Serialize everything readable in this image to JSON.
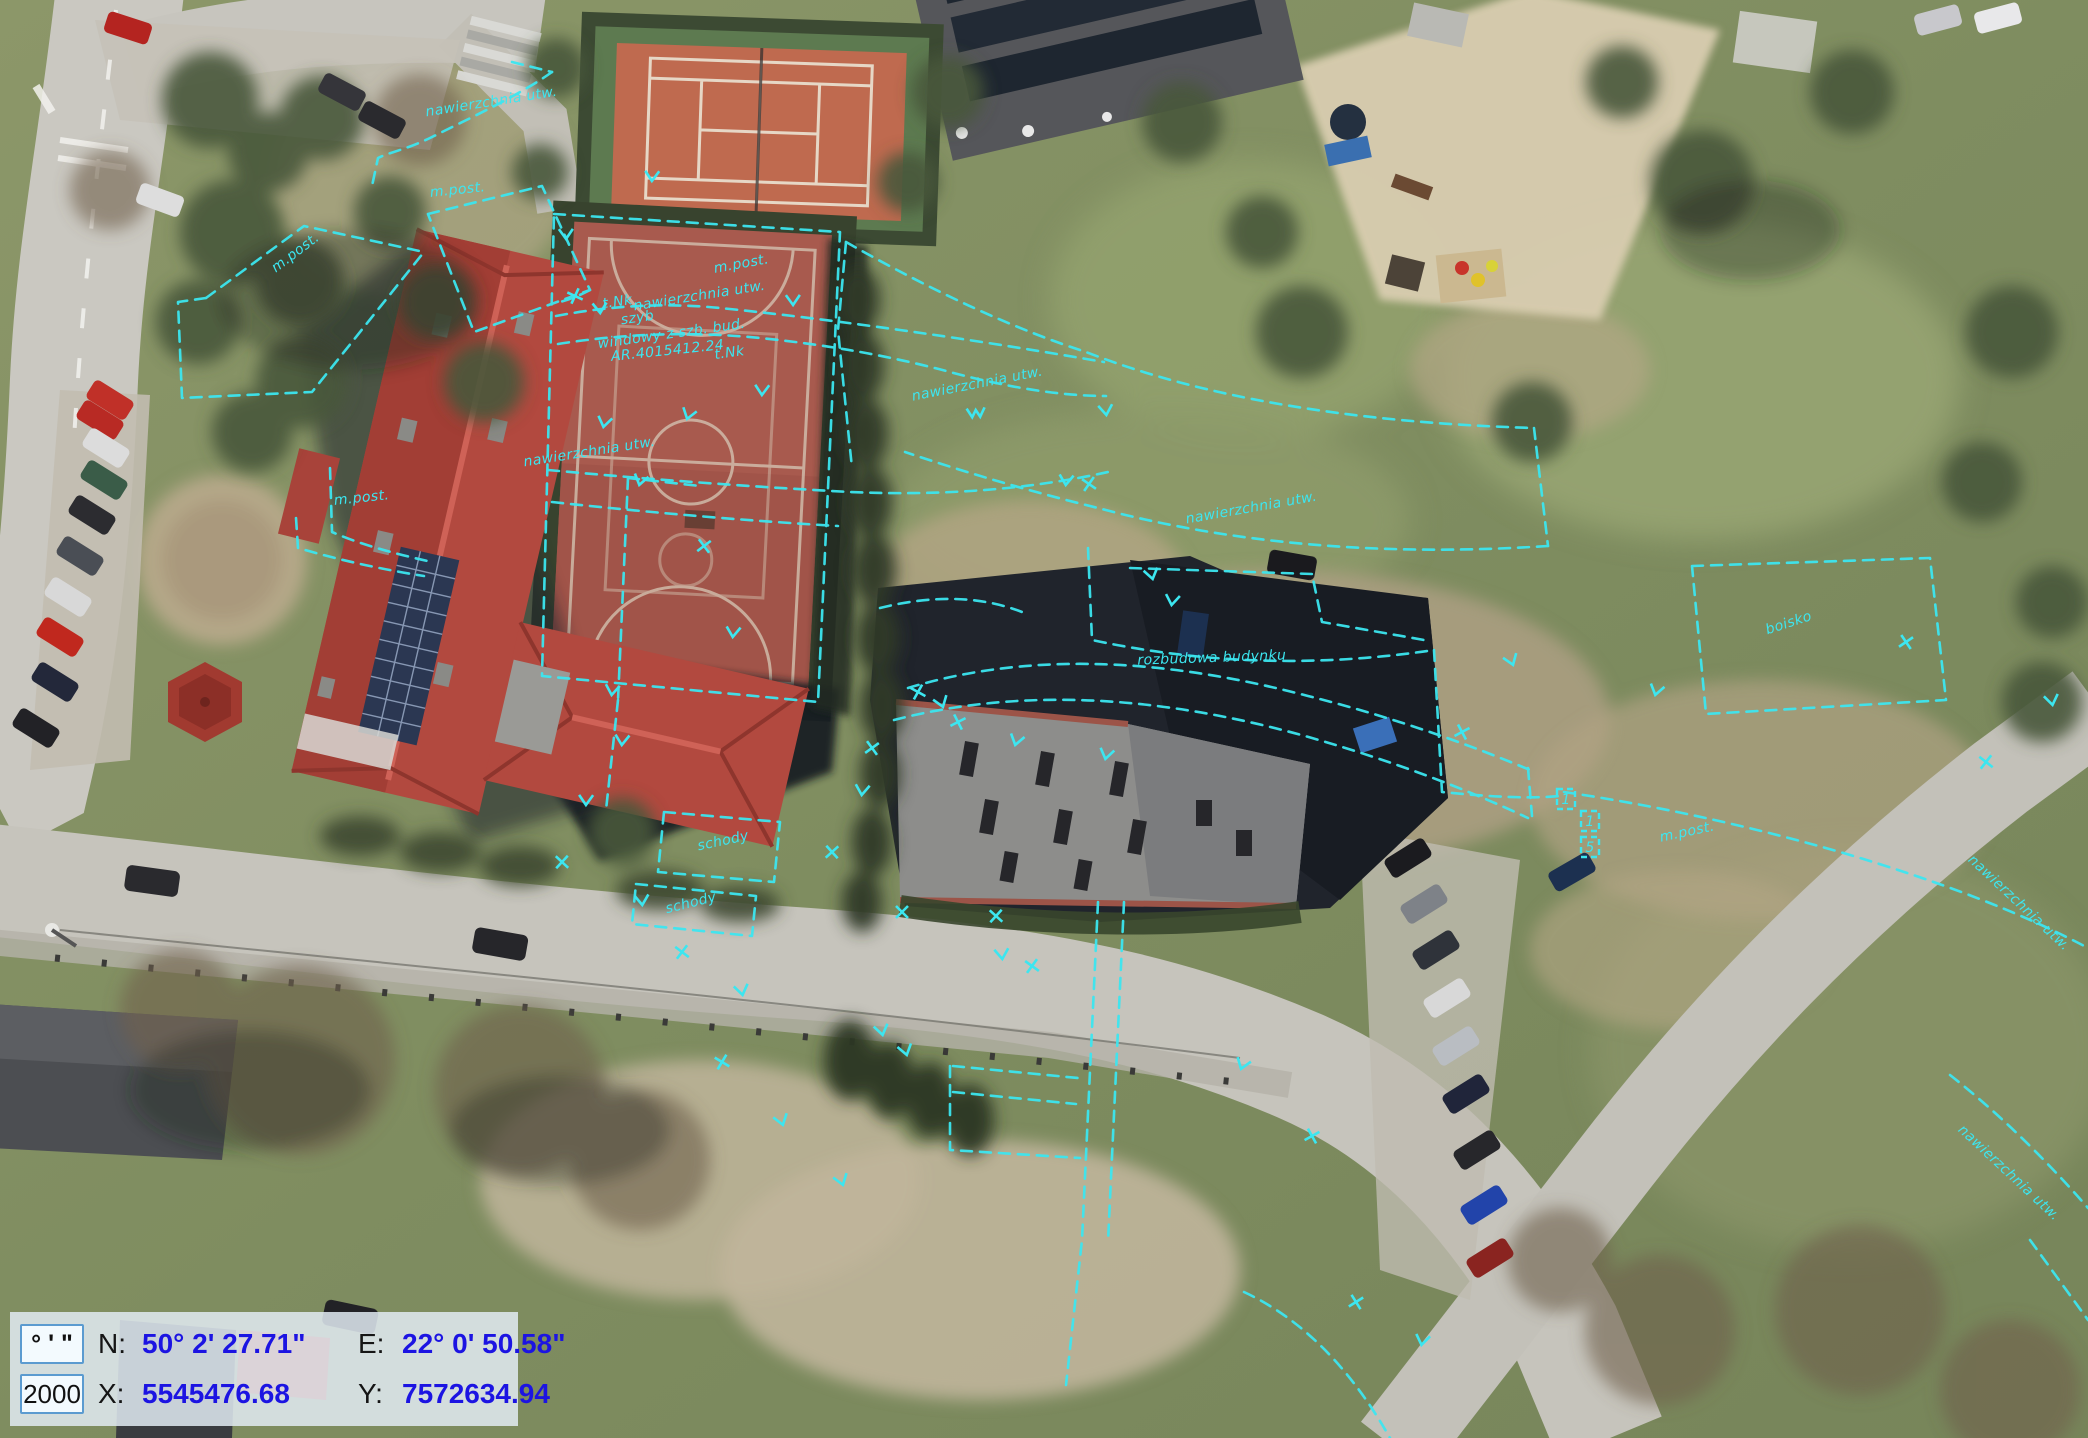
{
  "app": {
    "view": "aerial-survey-map"
  },
  "coordinate_panel": {
    "unit_format_button": "° ' \"",
    "crs_code_button": "2000",
    "lat_label": "N:",
    "lat_value": "50° 2' 27.71\"",
    "lon_label": "E:",
    "lon_value": "22° 0' 50.58\"",
    "x_label": "X:",
    "x_value": "5545476.68",
    "y_label": "Y:",
    "y_value": "7572634.94",
    "value_color": "#1c14e2"
  },
  "overlay": {
    "color": "#3ce6f0",
    "labels": [
      {
        "text": "nawierzchnia utw.",
        "x": 492,
        "y": 106,
        "rot": -9
      },
      {
        "text": "m.post.",
        "x": 298,
        "y": 256,
        "rot": -37
      },
      {
        "text": "m.post.",
        "x": 458,
        "y": 194,
        "rot": -6
      },
      {
        "text": "t.Nk",
        "x": 618,
        "y": 306,
        "rot": -8
      },
      {
        "text": "szyb",
        "x": 638,
        "y": 322,
        "rot": -8
      },
      {
        "text": "windowy z szb. bud.",
        "x": 672,
        "y": 338,
        "rot": -8
      },
      {
        "text": "AR.4015412.24",
        "x": 668,
        "y": 355,
        "rot": -6
      },
      {
        "text": "t.Nk",
        "x": 730,
        "y": 357,
        "rot": -8
      },
      {
        "text": "m.post.",
        "x": 742,
        "y": 268,
        "rot": -10
      },
      {
        "text": "nawierzchnia utw.",
        "x": 700,
        "y": 300,
        "rot": -9
      },
      {
        "text": "nawierzchnia utw.",
        "x": 590,
        "y": 456,
        "rot": -9
      },
      {
        "text": "nawierzchnia utw.",
        "x": 978,
        "y": 388,
        "rot": -11
      },
      {
        "text": "nawierzchnia utw.",
        "x": 1252,
        "y": 512,
        "rot": -10
      },
      {
        "text": "rozbudowa budynku",
        "x": 1212,
        "y": 662,
        "rot": -2
      },
      {
        "text": "boisko",
        "x": 1790,
        "y": 627,
        "rot": -18
      },
      {
        "text": "m.post.",
        "x": 1688,
        "y": 836,
        "rot": -12
      },
      {
        "text": "m.post.",
        "x": 362,
        "y": 502,
        "rot": -6
      },
      {
        "text": "schody",
        "x": 724,
        "y": 845,
        "rot": -12
      },
      {
        "text": "schody",
        "x": 692,
        "y": 907,
        "rot": -14
      },
      {
        "text": "nawierzchnia utw.",
        "x": 2016,
        "y": 906,
        "rot": 43
      },
      {
        "text": "nawierzchnia utw.",
        "x": 2006,
        "y": 1176,
        "rot": 43
      }
    ],
    "number_boxes": [
      {
        "value": "1",
        "x": 1566,
        "y": 800
      },
      {
        "value": "1",
        "x": 1590,
        "y": 822
      },
      {
        "value": "5",
        "x": 1590,
        "y": 848
      }
    ],
    "ticks": [
      {
        "x": 575,
        "y": 296,
        "t": "x"
      },
      {
        "x": 688,
        "y": 416,
        "t": "v"
      },
      {
        "x": 640,
        "y": 482,
        "t": "v"
      },
      {
        "x": 604,
        "y": 424,
        "t": "v"
      },
      {
        "x": 704,
        "y": 546,
        "t": "x"
      },
      {
        "x": 733,
        "y": 634,
        "t": "v"
      },
      {
        "x": 762,
        "y": 392,
        "t": "v"
      },
      {
        "x": 793,
        "y": 302,
        "t": "v"
      },
      {
        "x": 976,
        "y": 414,
        "t": "w"
      },
      {
        "x": 1106,
        "y": 412,
        "t": "v"
      },
      {
        "x": 1089,
        "y": 484,
        "t": "x"
      },
      {
        "x": 1152,
        "y": 576,
        "t": "v"
      },
      {
        "x": 918,
        "y": 692,
        "t": "x"
      },
      {
        "x": 942,
        "y": 704,
        "t": "v"
      },
      {
        "x": 958,
        "y": 722,
        "t": "x"
      },
      {
        "x": 1016,
        "y": 742,
        "t": "v"
      },
      {
        "x": 1106,
        "y": 756,
        "t": "v"
      },
      {
        "x": 872,
        "y": 748,
        "t": "x"
      },
      {
        "x": 862,
        "y": 792,
        "t": "v"
      },
      {
        "x": 832,
        "y": 852,
        "t": "x"
      },
      {
        "x": 902,
        "y": 912,
        "t": "x"
      },
      {
        "x": 996,
        "y": 916,
        "t": "x"
      },
      {
        "x": 1002,
        "y": 956,
        "t": "v"
      },
      {
        "x": 1032,
        "y": 966,
        "t": "x"
      },
      {
        "x": 882,
        "y": 1032,
        "t": "v"
      },
      {
        "x": 906,
        "y": 1052,
        "t": "v"
      },
      {
        "x": 842,
        "y": 1182,
        "t": "v"
      },
      {
        "x": 1242,
        "y": 1066,
        "t": "v"
      },
      {
        "x": 1312,
        "y": 1136,
        "t": "x"
      },
      {
        "x": 1356,
        "y": 1302,
        "t": "x"
      },
      {
        "x": 1422,
        "y": 1342,
        "t": "v"
      },
      {
        "x": 612,
        "y": 692,
        "t": "v"
      },
      {
        "x": 622,
        "y": 742,
        "t": "v"
      },
      {
        "x": 586,
        "y": 802,
        "t": "v"
      },
      {
        "x": 562,
        "y": 862,
        "t": "x"
      },
      {
        "x": 642,
        "y": 902,
        "t": "v"
      },
      {
        "x": 682,
        "y": 952,
        "t": "x"
      },
      {
        "x": 742,
        "y": 992,
        "t": "v"
      },
      {
        "x": 722,
        "y": 1062,
        "t": "x"
      },
      {
        "x": 782,
        "y": 1122,
        "t": "v"
      },
      {
        "x": 1512,
        "y": 662,
        "t": "v"
      },
      {
        "x": 1462,
        "y": 732,
        "t": "x"
      },
      {
        "x": 1656,
        "y": 692,
        "t": "v"
      },
      {
        "x": 1906,
        "y": 642,
        "t": "x"
      },
      {
        "x": 1172,
        "y": 602,
        "t": "v"
      },
      {
        "x": 1066,
        "y": 482,
        "t": "v"
      },
      {
        "x": 652,
        "y": 178,
        "t": "v"
      },
      {
        "x": 566,
        "y": 236,
        "t": "v"
      },
      {
        "x": 600,
        "y": 310,
        "t": "v"
      },
      {
        "x": 1986,
        "y": 762,
        "t": "x"
      },
      {
        "x": 2052,
        "y": 702,
        "t": "v"
      }
    ]
  }
}
